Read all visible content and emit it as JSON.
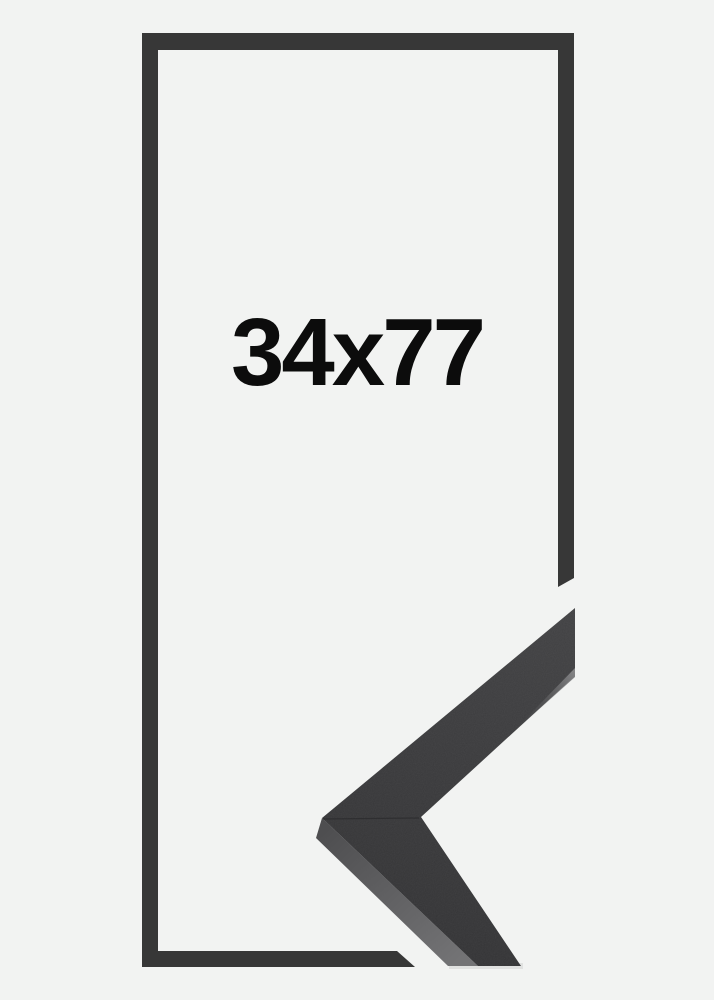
{
  "product_image": {
    "size_label": "34x77",
    "colors": {
      "background": "#f2f3f2",
      "frame_outline": "#373737",
      "label_text": "#0c0c0c",
      "corner_face_light": "#414143",
      "corner_face_dark": "#323234",
      "corner_bevel_dark": "#4e4e50",
      "corner_bevel_light": "#737375",
      "corner_tip_bevel_light": "#848486",
      "corner_tip_bevel_dark": "#48484a",
      "corner_seam": "#242426"
    }
  }
}
